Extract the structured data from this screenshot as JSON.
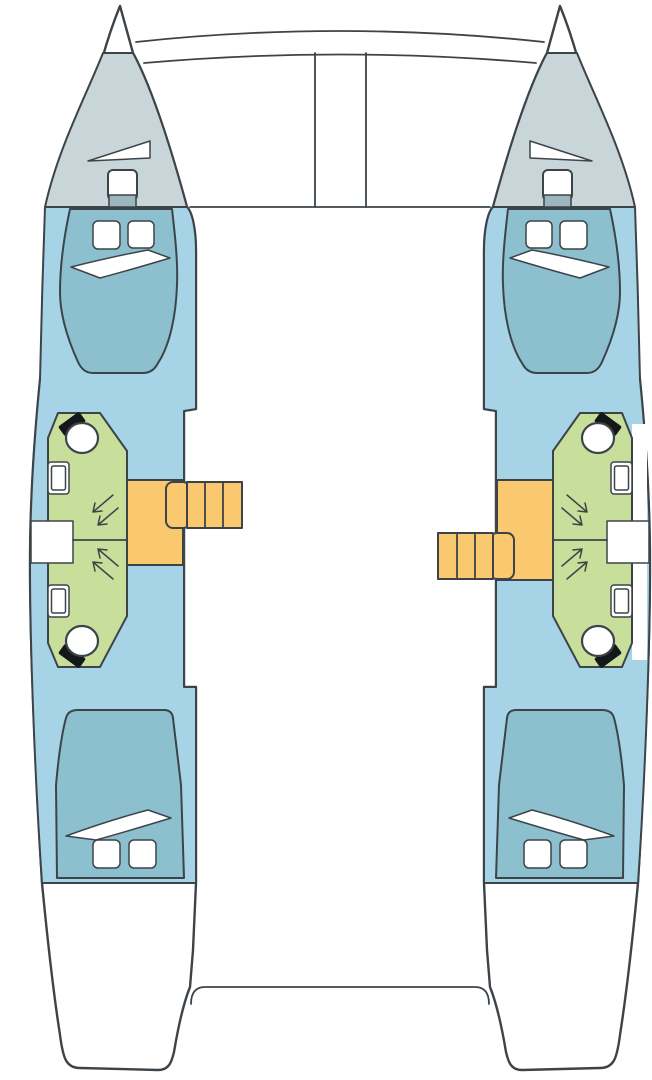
{
  "diagram": {
    "type": "catamaran-deck-plan",
    "view": "top-down floor plan",
    "vessel": "sailing catamaran, 4 cabins / 4 heads layout",
    "canvas": {
      "width": 652,
      "height": 1080,
      "background": "#ffffff"
    }
  },
  "colors": {
    "canvas": "#ffffff",
    "outline": "#3d4449",
    "hull": "#a6d4e6",
    "bed": "#8cc0cf",
    "foredeck": "#c8d6da",
    "head_compartment": "#c8df9b",
    "stairs": "#fac96f",
    "bulkhead_hatch": "#9db5bd",
    "fixture": "#ffffff",
    "toilet_seat": "#15181a"
  },
  "shared_features": [
    "bow crossbeam with trampoline edge lines",
    "anchor/bowsprit channel between hulls",
    "foredeck edge line",
    "aft cockpit platform edge between transoms"
  ],
  "port_hull_features": [
    "bow tip",
    "foredeck locker triangle hatch",
    "foredeck hatch",
    "windlass box",
    "forward cabin double berth with pillow and two deck hatches",
    "forward head: toilet, sink, shower arrows",
    "aft head: toilet, sink, shower arrows",
    "outboard shower gap",
    "companionway landing",
    "companionway stairs (upper position)",
    "aft cabin double berth with pillow and two deck hatches",
    "transom sugar-scoop step"
  ],
  "starboard_hull_features": [
    "bow tip",
    "foredeck locker triangle hatch",
    "foredeck hatch",
    "windlass box",
    "forward cabin double berth with pillow and two deck hatches",
    "forward head: toilet, sink, shower arrows",
    "aft head: toilet, sink, shower arrows",
    "outboard walkway strip",
    "outboard shower gap",
    "companionway landing",
    "companionway stairs (lower position)",
    "aft cabin double berth with pillow and two deck hatches",
    "transom sugar-scoop step"
  ]
}
